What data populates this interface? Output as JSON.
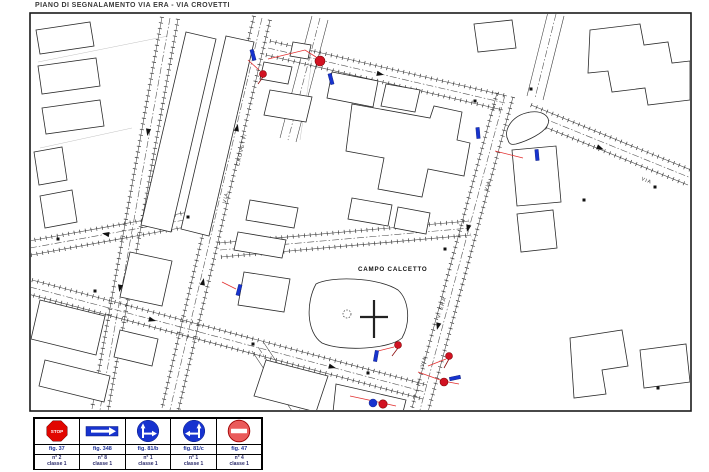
{
  "title": "PIANO DI SEGNALAMENTO VIA ERA - VIA CROVETTI",
  "map": {
    "area_label": "CAMPO CALCETTO",
    "street_labels": [
      {
        "text": "CROVETTI"
      },
      {
        "text": "VIA"
      },
      {
        "text": "V. ERA"
      },
      {
        "text": "VIA"
      },
      {
        "text": "VIA"
      },
      {
        "text": "VIA"
      }
    ]
  },
  "legend": {
    "items": [
      {
        "fig": "fig. 37",
        "count": "n° 2",
        "classe": "classe 1",
        "icon": "stop-sign"
      },
      {
        "fig": "fig. 348",
        "count": "n° 8",
        "classe": "classe 1",
        "icon": "one-way-sign"
      },
      {
        "fig": "fig. 81/b",
        "count": "n° 1",
        "classe": "classe 1",
        "icon": "straight-or-right-sign"
      },
      {
        "fig": "fig. 81/c",
        "count": "n° 1",
        "classe": "classe 1",
        "icon": "straight-or-left-sign"
      },
      {
        "fig": "fig. 47",
        "count": "n° 4",
        "classe": "classe 1",
        "icon": "no-entry-sign"
      }
    ],
    "sign_text_stop": "STOP"
  },
  "colors": {
    "sign_red": "#e10600",
    "sign_blue": "#1733cf",
    "no_entry_fill": "#ea5b5b",
    "marker_red": "#d21222",
    "marker_blue": "#1733cf",
    "leader_red": "#e23030"
  }
}
